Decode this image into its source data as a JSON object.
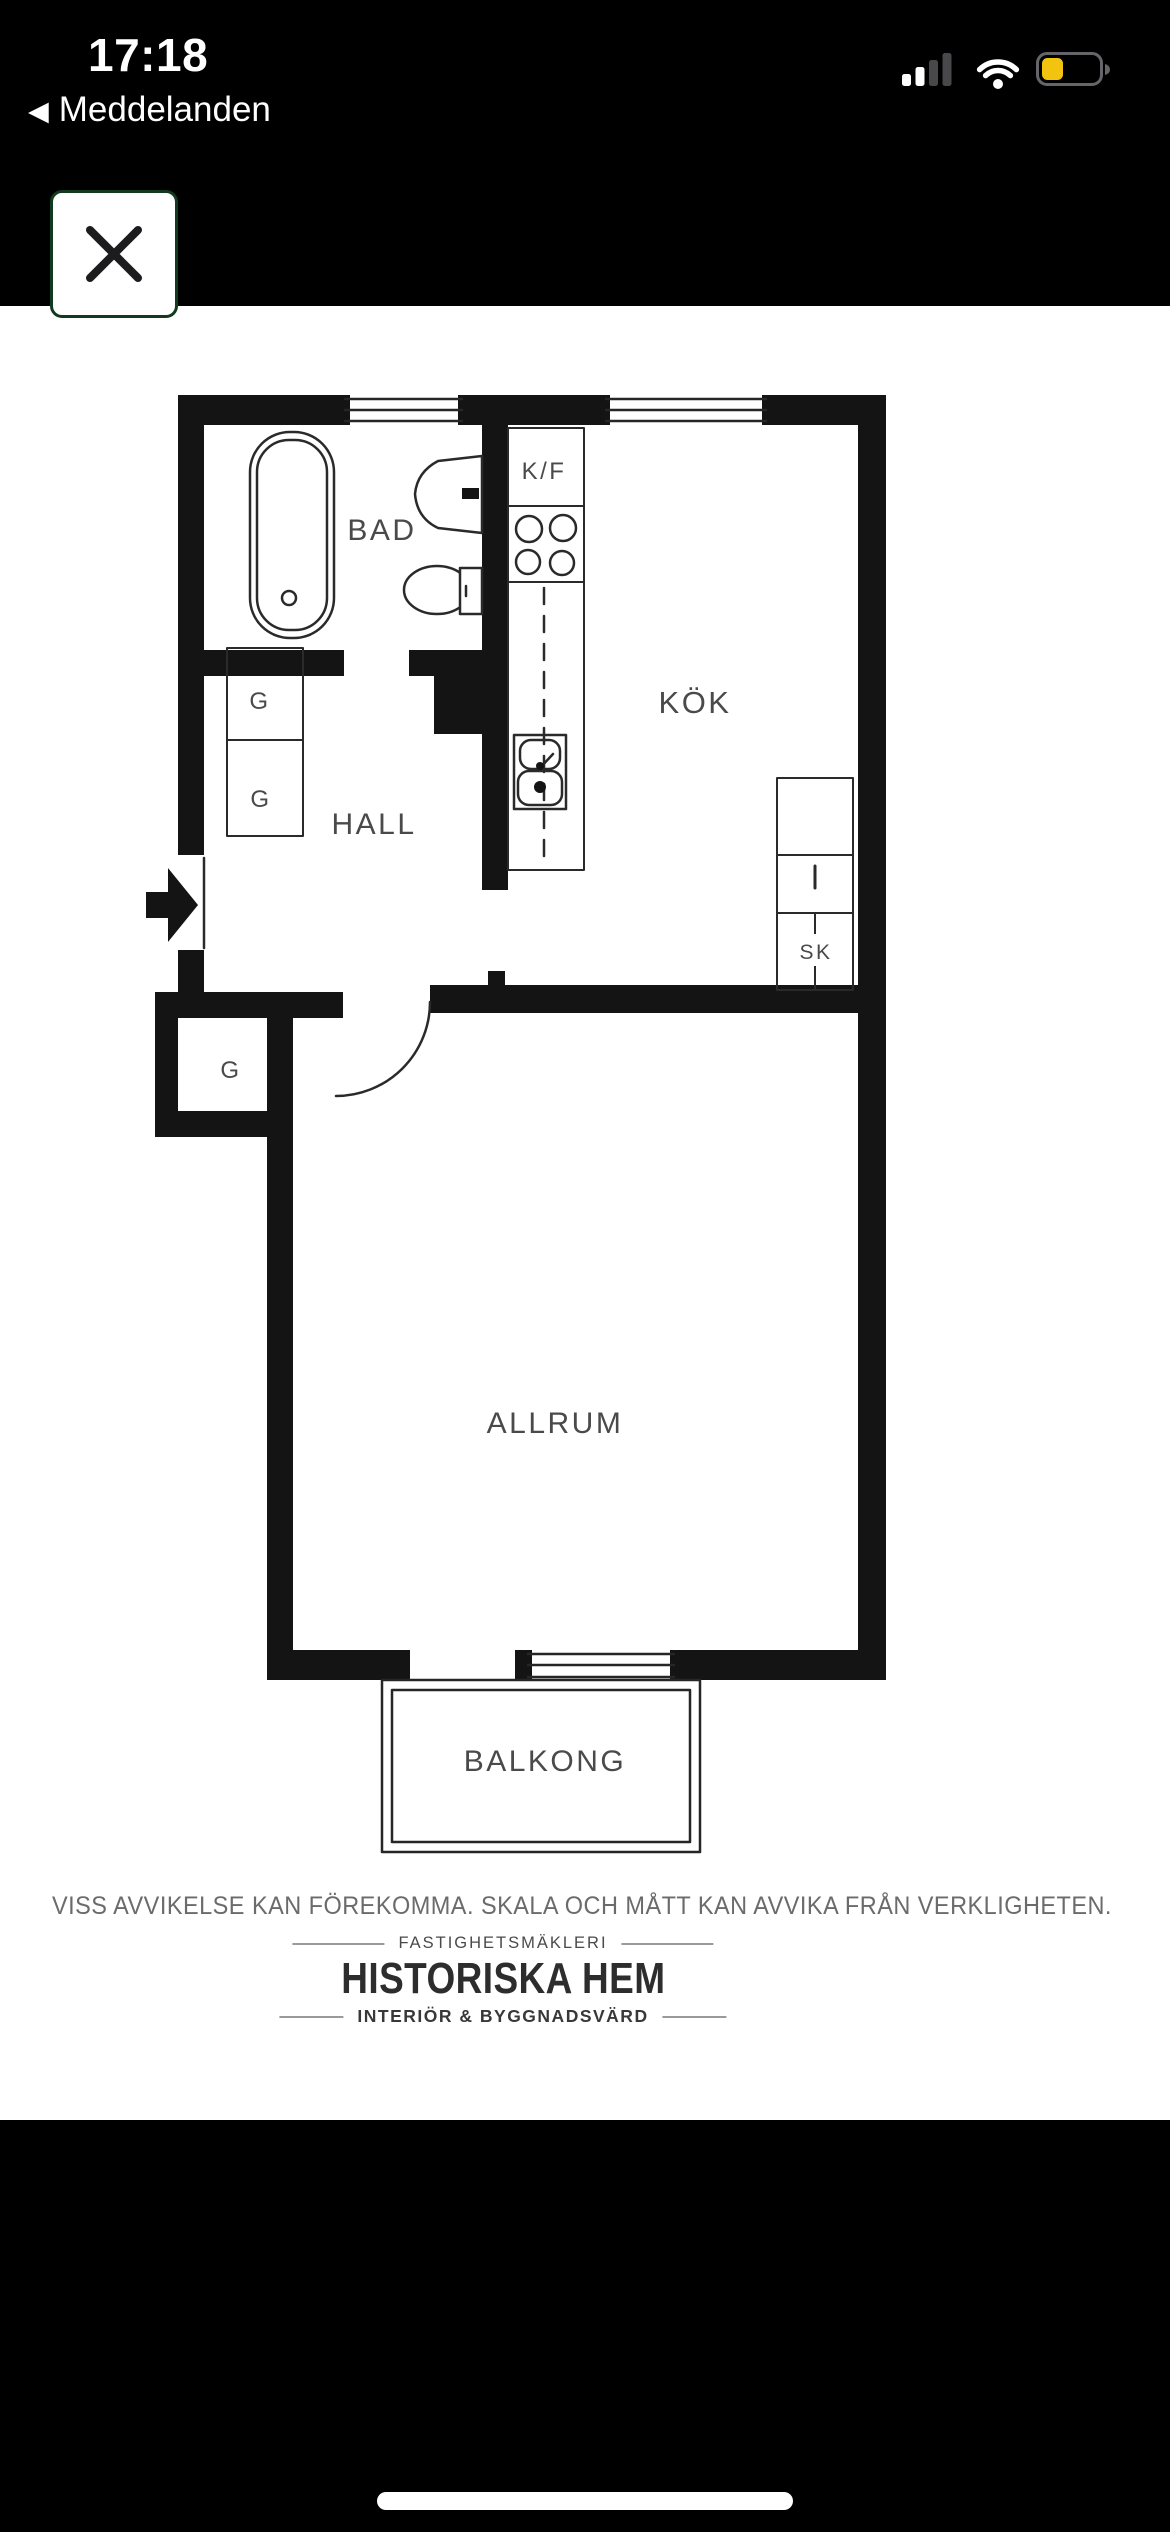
{
  "status_bar": {
    "time": "17:18",
    "back_label": "Meddelanden",
    "back_chevron": "◀"
  },
  "colors": {
    "battery_level_yellow": "#f2c40f",
    "battery_shell_gray": "#65656a",
    "signal_dim_gray": "#48484a",
    "close_button_border_green": "#123a1f",
    "plan_wall_black": "#141414"
  },
  "floor_plan": {
    "rooms": {
      "bad": "BAD",
      "kok": "KÖK",
      "hall": "HALL",
      "allrum": "ALLRUM",
      "balkong": "BALKONG"
    },
    "fixtures": {
      "kf": "K/F",
      "sk": "SK",
      "g_upper": "G",
      "g_lower": "G",
      "g_entry": "G"
    }
  },
  "footer": {
    "disclaimer": "VISS AVVIKELSE KAN FÖREKOMMA. SKALA OCH MÅTT KAN AVVIKA FRÅN VERKLIGHETEN.",
    "brand": {
      "top": "FASTIGHETSMÄKLERI",
      "name": "HISTORISKA HEM",
      "bottom": "INTERIÖR & BYGGNADSVÄRD"
    }
  }
}
